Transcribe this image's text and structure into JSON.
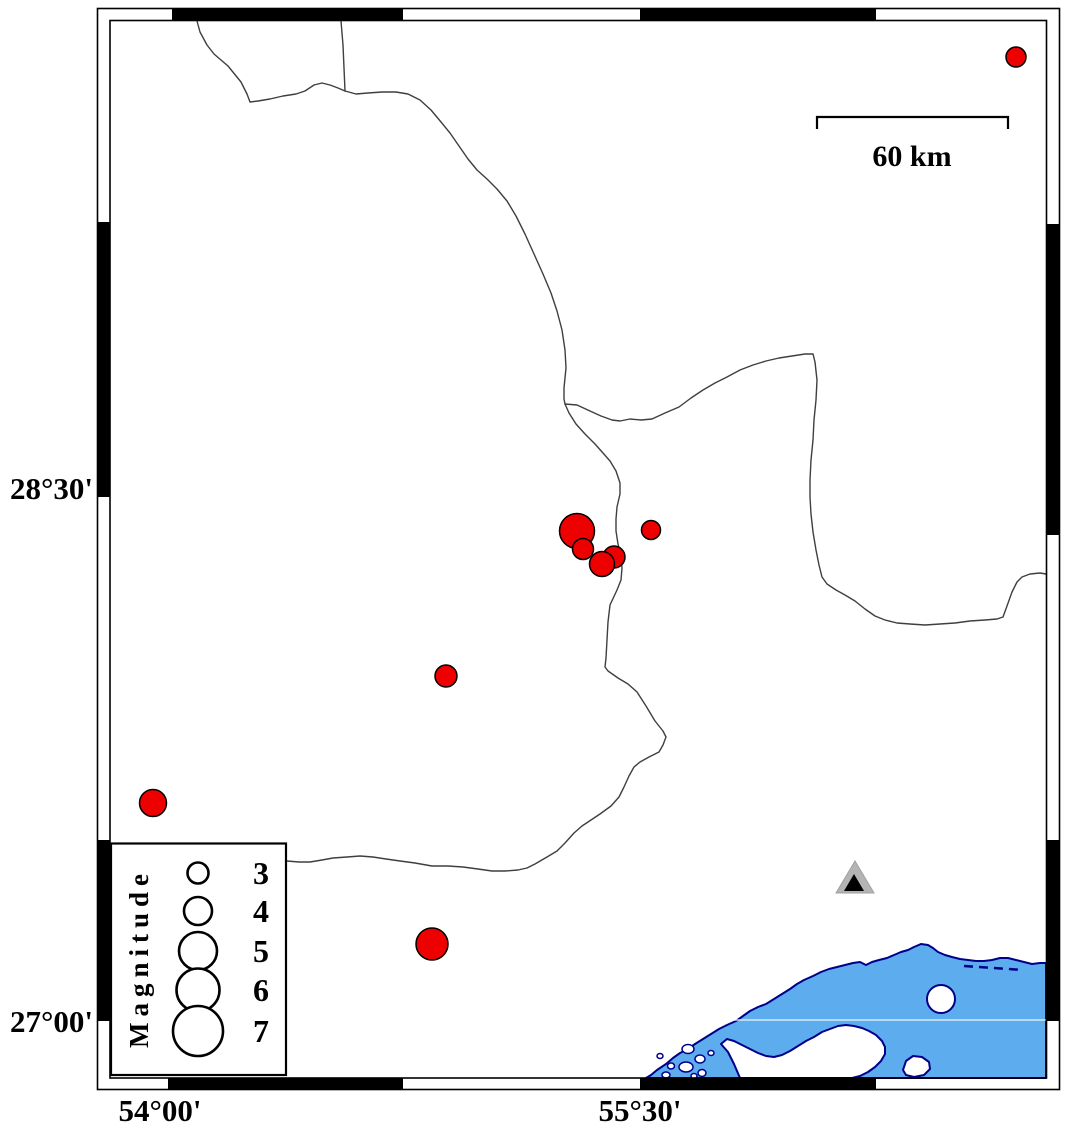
{
  "axis": {
    "lat_labels": [
      {
        "text": "28°30'",
        "y": 488
      },
      {
        "text": "27°00'",
        "y": 1021
      }
    ],
    "lon_labels": [
      {
        "text": "54°00'",
        "x": 160
      },
      {
        "text": "55°30'",
        "x": 640
      }
    ]
  },
  "scale_bar": {
    "label": "60 km",
    "x1": 817,
    "x2": 1008,
    "y": 117
  },
  "legend": {
    "title": "Magnitude",
    "items": [
      {
        "label": "3",
        "cy": 873,
        "r": 10.5
      },
      {
        "label": "4",
        "cy": 911,
        "r": 14
      },
      {
        "label": "5",
        "cy": 951,
        "r": 19
      },
      {
        "label": "6",
        "cy": 990,
        "r": 21.5
      },
      {
        "label": "7",
        "cy": 1031,
        "r": 25
      }
    ],
    "circle_cx": 198,
    "label_cx": 261
  },
  "earthquakes": [
    {
      "x": 1016,
      "y": 57,
      "r": 10
    },
    {
      "x": 577,
      "y": 531,
      "r": 17.5
    },
    {
      "x": 583,
      "y": 549,
      "r": 10.5
    },
    {
      "x": 614,
      "y": 557,
      "r": 11
    },
    {
      "x": 602,
      "y": 564,
      "r": 12.5
    },
    {
      "x": 651,
      "y": 530,
      "r": 9.5
    },
    {
      "x": 446,
      "y": 676,
      "r": 11
    },
    {
      "x": 153,
      "y": 803,
      "r": 13.5
    },
    {
      "x": 432,
      "y": 944,
      "r": 16
    }
  ],
  "station": {
    "x": 855,
    "y": 880
  },
  "colors": {
    "earthquake": "#ee0000",
    "marker_outline": "#000000",
    "water": "#5cacee",
    "coast": "#00008b",
    "boundary_line": "#3f3f3f",
    "station_outer": "#b4b4b4",
    "station_inner": "#000000",
    "frame": "#000000"
  }
}
